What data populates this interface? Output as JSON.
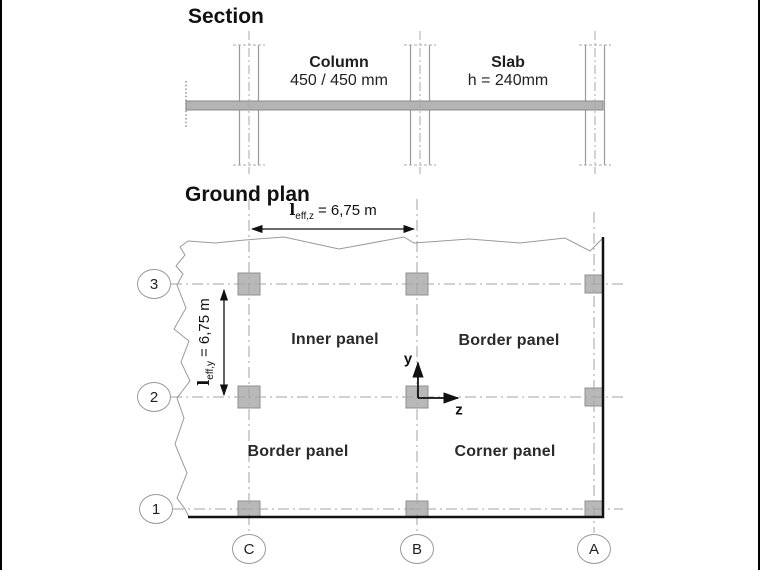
{
  "colors": {
    "line_gray": "#9a9a9a",
    "grid_gray": "#a3a3a3",
    "fill_gray": "#b8b8b8",
    "fill_border": "#8a8a8a",
    "edge_black": "#111111",
    "text": "#1a1a1a"
  },
  "section": {
    "title": "Section",
    "column_label": "Column",
    "column_dim": "450 / 450 mm",
    "slab_label": "Slab",
    "slab_dim": "h = 240mm"
  },
  "ground_plan": {
    "title": "Ground plan",
    "dim_z": {
      "symbol": "l",
      "subscript": "eff,z",
      "value": "= 6,75 m"
    },
    "dim_y": {
      "symbol": "l",
      "subscript": "eff,y",
      "value": "= 6,75 m"
    },
    "panels": {
      "inner": "Inner panel",
      "border_top": "Border panel",
      "border_bottom": "Border panel",
      "corner": "Corner panel"
    },
    "axes": {
      "vertical": "y",
      "horizontal": "z"
    },
    "row_labels": [
      "3",
      "2",
      "1"
    ],
    "col_labels": [
      "C",
      "B",
      "A"
    ]
  }
}
